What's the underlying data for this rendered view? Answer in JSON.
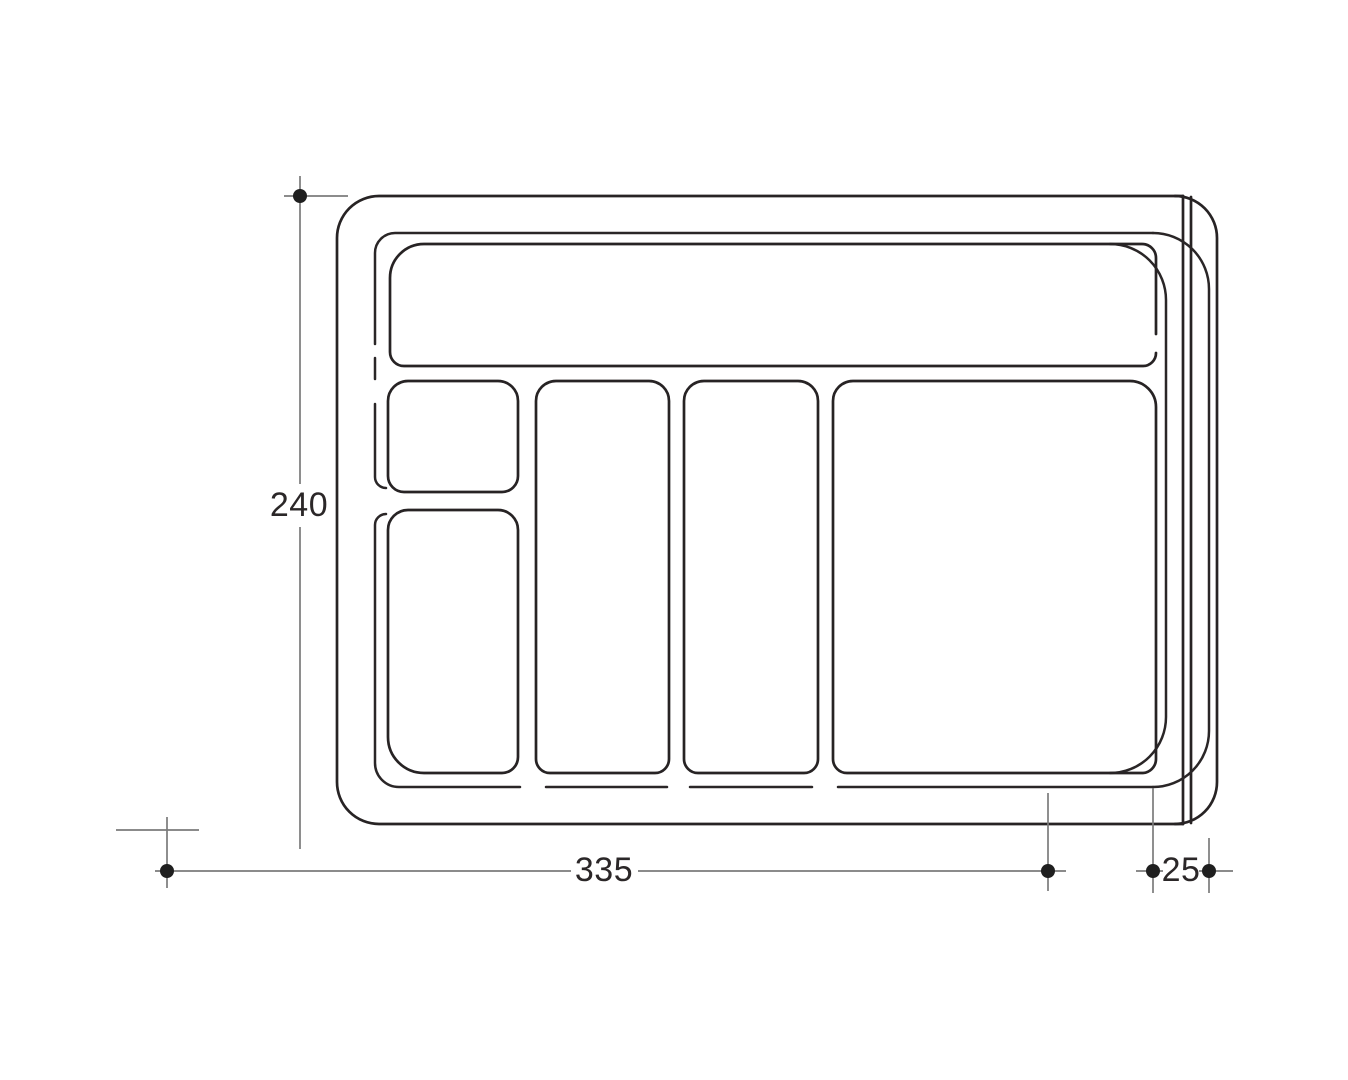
{
  "drawing": {
    "labels": {
      "height": "240",
      "width": "335",
      "trim": "25"
    },
    "colors": {
      "outline": "#272324",
      "rim": "#2a2627",
      "dimension": "#7b7b7b",
      "marker": "#1f1f1f",
      "text": "#2b2728",
      "background": "#ffffff"
    }
  }
}
